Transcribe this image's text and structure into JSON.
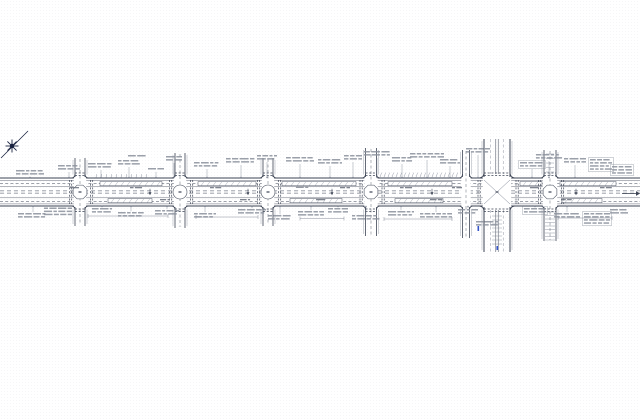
{
  "canvas": {
    "width": 640,
    "height": 420,
    "background": "#ffffff"
  },
  "colors": {
    "line": "#3d4454",
    "thin": "#7a8190",
    "smudge": "#8d939e",
    "dark_smudge": "#6d7380",
    "blue": "#3555c8",
    "paper": "#ffffff"
  },
  "north_arrow": {
    "cx": 12,
    "cy": 146,
    "ray": 6.5,
    "line": [
      1,
      158,
      28,
      131
    ]
  },
  "road": {
    "x0": 0,
    "x1": 640,
    "y_top": 178,
    "y_bottom": 206,
    "lane_lines": [
      {
        "y": 178,
        "w": 0.9
      },
      {
        "y": 180.4,
        "w": 0.4
      },
      {
        "y": 183.6,
        "w": 0.5,
        "dash": "3,2.2"
      },
      {
        "y": 186.6,
        "w": 0.4
      },
      {
        "y": 190.9,
        "w": 0.5,
        "dash": "4,3"
      },
      {
        "y": 193.1,
        "w": 0.5,
        "dash": "4,3"
      },
      {
        "y": 197.8,
        "w": 0.4
      },
      {
        "y": 201.4,
        "w": 0.5,
        "dash": "3,2.2"
      },
      {
        "y": 203.9,
        "w": 0.4
      },
      {
        "y": 206,
        "w": 0.9
      }
    ]
  },
  "median_rects": [
    {
      "x": 100,
      "y": 181.6,
      "w": 62,
      "h": 4.2
    },
    {
      "x": 198,
      "y": 181.6,
      "w": 58,
      "h": 4.2
    },
    {
      "x": 282,
      "y": 181.6,
      "w": 74,
      "h": 4.2
    },
    {
      "x": 388,
      "y": 181.6,
      "w": 64,
      "h": 4.2
    },
    {
      "x": 520,
      "y": 181.6,
      "w": 22,
      "h": 4.2
    },
    {
      "x": 560,
      "y": 181.6,
      "w": 56,
      "h": 4.2
    },
    {
      "x": 108,
      "y": 198.6,
      "w": 44,
      "h": 4.2
    },
    {
      "x": 290,
      "y": 198.6,
      "w": 52,
      "h": 4.2
    },
    {
      "x": 395,
      "y": 198.6,
      "w": 48,
      "h": 4.2
    },
    {
      "x": 562,
      "y": 198.6,
      "w": 40,
      "h": 4.2
    }
  ],
  "intersections": [
    {
      "x": 80,
      "sw": 5,
      "top": 158,
      "bottom": 226,
      "style": "oct",
      "crosswalks": true
    },
    {
      "x": 180,
      "sw": 5,
      "top": 153,
      "bottom": 228,
      "style": "circle",
      "crosswalks": true
    },
    {
      "x": 268,
      "sw": 5,
      "top": 158,
      "bottom": 226,
      "style": "circle",
      "crosswalks": true
    },
    {
      "x": 371,
      "sw": 5.5,
      "top": 148,
      "bottom": 236,
      "style": "oct",
      "crosswalks": true
    },
    {
      "x": 466,
      "sw": 3.5,
      "top": 150,
      "bottom": 238,
      "style": "none",
      "crosswalks": false
    },
    {
      "x": 497,
      "sw": 13,
      "top": 139,
      "bottom": 252,
      "style": "major",
      "crosswalks": true
    },
    {
      "x": 550,
      "sw": 6,
      "top": 150,
      "bottom": 241,
      "style": "oct",
      "crosswalks": true
    }
  ],
  "tick_rows": [
    {
      "x0": 96,
      "x1": 146,
      "y": 177.6,
      "len": 3.5,
      "step": 5,
      "slant": 0.8
    },
    {
      "x0": 380,
      "x1": 458,
      "y": 177.2,
      "len": 4.5,
      "step": 4,
      "slant": 1.6
    }
  ],
  "htick_rows": [
    {
      "x0": 545,
      "x1": 555,
      "y0": 212,
      "y1": 240,
      "step": 3.5
    },
    {
      "x0": 546,
      "x1": 554,
      "y0": 154,
      "y1": 172,
      "step": 4.5
    },
    {
      "x0": 492,
      "x1": 502,
      "y0": 216,
      "y1": 246,
      "step": 4
    }
  ],
  "arrow_marks": [
    {
      "x": 150,
      "y": 191.8
    },
    {
      "x": 248,
      "y": 191.8
    },
    {
      "x": 332,
      "y": 191.8
    },
    {
      "x": 432,
      "y": 191.8
    },
    {
      "x": 576,
      "y": 191.8
    }
  ],
  "blue_marks": [
    {
      "x": 477.5,
      "y": 226,
      "w": 1.6,
      "h": 5
    },
    {
      "x": 496.5,
      "y": 246,
      "w": 1.6,
      "h": 4
    }
  ],
  "annotations": [
    {
      "x": 16,
      "y": 170,
      "w": 28,
      "rows": 2
    },
    {
      "x": 58,
      "y": 165,
      "w": 22,
      "rows": 2
    },
    {
      "x": 88,
      "y": 163,
      "w": 26,
      "rows": 2
    },
    {
      "x": 118,
      "y": 160,
      "w": 22,
      "rows": 2
    },
    {
      "x": 128,
      "y": 155,
      "w": 18,
      "rows": 1,
      "leader": false
    },
    {
      "x": 148,
      "y": 168,
      "w": 16,
      "rows": 1
    },
    {
      "x": 166,
      "y": 156,
      "w": 16,
      "rows": 2
    },
    {
      "x": 194,
      "y": 162,
      "w": 26,
      "rows": 2
    },
    {
      "x": 226,
      "y": 158,
      "w": 30,
      "rows": 2
    },
    {
      "x": 257,
      "y": 155,
      "w": 20,
      "rows": 2
    },
    {
      "x": 286,
      "y": 157,
      "w": 28,
      "rows": 2
    },
    {
      "x": 318,
      "y": 159,
      "w": 24,
      "rows": 2
    },
    {
      "x": 344,
      "y": 155,
      "w": 18,
      "rows": 2
    },
    {
      "x": 364,
      "y": 151,
      "w": 26,
      "rows": 2
    },
    {
      "x": 392,
      "y": 157,
      "w": 20,
      "rows": 2
    },
    {
      "x": 410,
      "y": 153,
      "w": 34,
      "rows": 2
    },
    {
      "x": 440,
      "y": 159,
      "w": 20,
      "rows": 2
    },
    {
      "x": 466,
      "y": 148,
      "w": 24,
      "rows": 2
    },
    {
      "x": 520,
      "y": 162,
      "w": 24,
      "rows": 2,
      "boxed": true
    },
    {
      "x": 536,
      "y": 154,
      "w": 26,
      "rows": 2
    },
    {
      "x": 564,
      "y": 158,
      "w": 22,
      "rows": 2
    },
    {
      "x": 590,
      "y": 159,
      "w": 22,
      "rows": 4,
      "boxed": true,
      "leader": false
    },
    {
      "x": 612,
      "y": 166,
      "w": 20,
      "rows": 3,
      "boxed": true,
      "leader": false
    },
    {
      "x": 18,
      "y": 213,
      "w": 30,
      "rows": 2
    },
    {
      "x": 44,
      "y": 207.5,
      "w": 28,
      "rows": 3,
      "leader": false
    },
    {
      "x": 92,
      "y": 208,
      "w": 20,
      "rows": 2
    },
    {
      "x": 118,
      "y": 212,
      "w": 26,
      "rows": 2
    },
    {
      "x": 155,
      "y": 210,
      "w": 24,
      "rows": 2
    },
    {
      "x": 194,
      "y": 213,
      "w": 22,
      "rows": 2
    },
    {
      "x": 238,
      "y": 209,
      "w": 28,
      "rows": 2
    },
    {
      "x": 268,
      "y": 215,
      "w": 24,
      "rows": 2
    },
    {
      "x": 298,
      "y": 211,
      "w": 26,
      "rows": 2
    },
    {
      "x": 328,
      "y": 208,
      "w": 20,
      "rows": 2
    },
    {
      "x": 352,
      "y": 215,
      "w": 28,
      "rows": 2
    },
    {
      "x": 388,
      "y": 211,
      "w": 26,
      "rows": 2
    },
    {
      "x": 420,
      "y": 213,
      "w": 32,
      "rows": 2
    },
    {
      "x": 458,
      "y": 209,
      "w": 20,
      "rows": 2
    },
    {
      "x": 476,
      "y": 221,
      "w": 24,
      "rows": 2,
      "leader": false
    },
    {
      "x": 524,
      "y": 208,
      "w": 22,
      "rows": 2,
      "boxed": true
    },
    {
      "x": 554,
      "y": 213,
      "w": 26,
      "rows": 2
    },
    {
      "x": 584,
      "y": 213,
      "w": 26,
      "rows": 4,
      "boxed": true,
      "leader": false
    },
    {
      "x": 610,
      "y": 209,
      "w": 18,
      "rows": 2,
      "leader": false
    },
    {
      "x": 70,
      "y": 187,
      "w": 10,
      "rows": 1,
      "leader": false,
      "tone": "dark"
    },
    {
      "x": 130,
      "y": 187,
      "w": 12,
      "rows": 1,
      "leader": false,
      "tone": "dark"
    },
    {
      "x": 160,
      "y": 199,
      "w": 10,
      "rows": 1,
      "leader": false,
      "tone": "dark"
    },
    {
      "x": 210,
      "y": 187,
      "w": 12,
      "rows": 1,
      "leader": false,
      "tone": "dark"
    },
    {
      "x": 240,
      "y": 199,
      "w": 10,
      "rows": 1,
      "leader": false,
      "tone": "dark"
    },
    {
      "x": 296,
      "y": 186.5,
      "w": 14,
      "rows": 1,
      "leader": false,
      "tone": "dark"
    },
    {
      "x": 316,
      "y": 199,
      "w": 12,
      "rows": 1,
      "leader": false,
      "tone": "dark"
    },
    {
      "x": 340,
      "y": 187,
      "w": 10,
      "rows": 1,
      "leader": false,
      "tone": "dark"
    },
    {
      "x": 400,
      "y": 187,
      "w": 12,
      "rows": 1,
      "leader": false,
      "tone": "dark"
    },
    {
      "x": 430,
      "y": 199,
      "w": 12,
      "rows": 1,
      "leader": false,
      "tone": "dark"
    },
    {
      "x": 452,
      "y": 187,
      "w": 10,
      "rows": 1,
      "leader": false,
      "tone": "dark"
    },
    {
      "x": 530,
      "y": 187,
      "w": 10,
      "rows": 1,
      "leader": false,
      "tone": "dark"
    },
    {
      "x": 562,
      "y": 199,
      "w": 12,
      "rows": 1,
      "leader": false,
      "tone": "dark"
    },
    {
      "x": 600,
      "y": 187,
      "w": 12,
      "rows": 1,
      "leader": false,
      "tone": "dark"
    }
  ],
  "dimensions": [
    {
      "x0": 88,
      "x1": 168,
      "y": 216
    },
    {
      "x0": 196,
      "x1": 258,
      "y": 217
    },
    {
      "x0": 300,
      "x1": 344,
      "y": 218.5
    },
    {
      "x0": 384,
      "x1": 452,
      "y": 219
    },
    {
      "x0": 558,
      "x1": 612,
      "y": 218
    }
  ],
  "end_arrow": {
    "x0": 622,
    "x1": 636,
    "y": 193.5
  }
}
